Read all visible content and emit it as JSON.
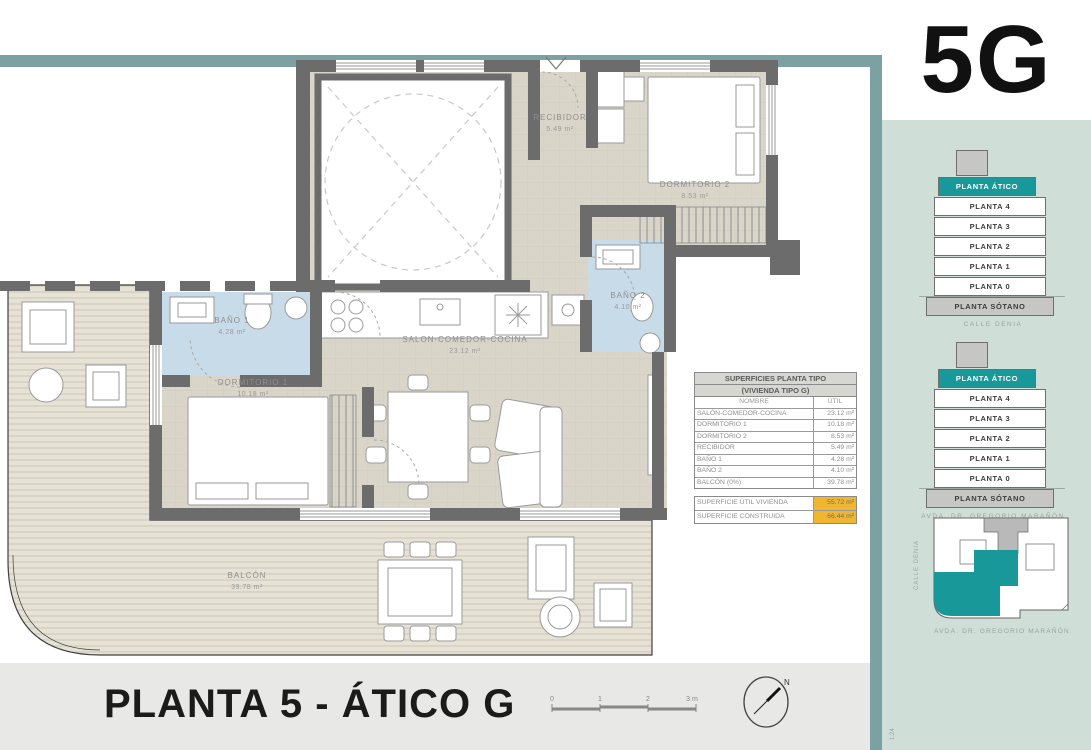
{
  "unit_label": "5G",
  "title": "PLANTA 5 - ÁTICO G",
  "compass": {
    "north_label": "N"
  },
  "scale": {
    "ticks": [
      "0",
      "1",
      "2",
      "3 m"
    ]
  },
  "rooms": [
    {
      "name": "RECIBIDOR",
      "area": "5.49 m²"
    },
    {
      "name": "DORMITORIO 2",
      "area": "8.53 m²"
    },
    {
      "name": "BAÑO 2",
      "area": "4.10 m²"
    },
    {
      "name": "BAÑO 1",
      "area": "4.28 m²"
    },
    {
      "name": "DORMITORIO 1",
      "area": "10.18 m²"
    },
    {
      "name": "SALON-COMEDOR-COCINA",
      "area": "23.12 m²"
    },
    {
      "name": "BALCÓN",
      "area": "39.78 m²"
    }
  ],
  "table": {
    "title_line1": "SUPERFICIES PLANTA TIPO",
    "title_line2": "(VIVIENDA TIPO G)",
    "col_name": "NOMBRE",
    "col_util": "ÚTIL",
    "rows": [
      {
        "name": "SALÓN-COMEDOR-COCINA",
        "util": "23.12 m²"
      },
      {
        "name": "DORMITORIO 1",
        "util": "10.18 m²"
      },
      {
        "name": "DORMITORIO 2",
        "util": "8.53 m²"
      },
      {
        "name": "RECIBIDOR",
        "util": "5.49 m²"
      },
      {
        "name": "BAÑO 1",
        "util": "4.28 m²"
      },
      {
        "name": "BAÑO 2",
        "util": "4.10 m²"
      },
      {
        "name": "BALCÓN (0%)",
        "util": "39.78 m²"
      }
    ],
    "totals": [
      {
        "name": "SUPERFICIE ÚTIL VIVIENDA",
        "value": "55.72 m²"
      },
      {
        "name": "SUPERFICIE CONSTRUIDA",
        "value": "66.44 m²"
      }
    ]
  },
  "sidebar": {
    "stacks": [
      {
        "floors": [
          "PLANTA ÁTICO",
          "PLANTA 4",
          "PLANTA 3",
          "PLANTA 2",
          "PLANTA 1",
          "PLANTA 0",
          "PLANTA SÓTANO"
        ],
        "highlight": "PLANTA ÁTICO",
        "caption": "CALLE DENIA"
      },
      {
        "floors": [
          "PLANTA ÁTICO",
          "PLANTA 4",
          "PLANTA 3",
          "PLANTA 2",
          "PLANTA 1",
          "PLANTA 0",
          "PLANTA SÓTANO"
        ],
        "highlight": "PLANTA ÁTICO",
        "caption": "AVDA. DR. GREGORIO MARAÑÓN"
      }
    ],
    "siteplan": {
      "street_left": "CALLE DENIA",
      "street_bottom": "AVDA. DR. GREGORIO MARAÑÓN"
    },
    "footnote": "1.24"
  },
  "colors": {
    "accent_teal": "#19989a",
    "frame_band": "#7ba1a3",
    "sidebar_mint": "#cfdfd7",
    "totals_orange": "#f0b62f"
  }
}
